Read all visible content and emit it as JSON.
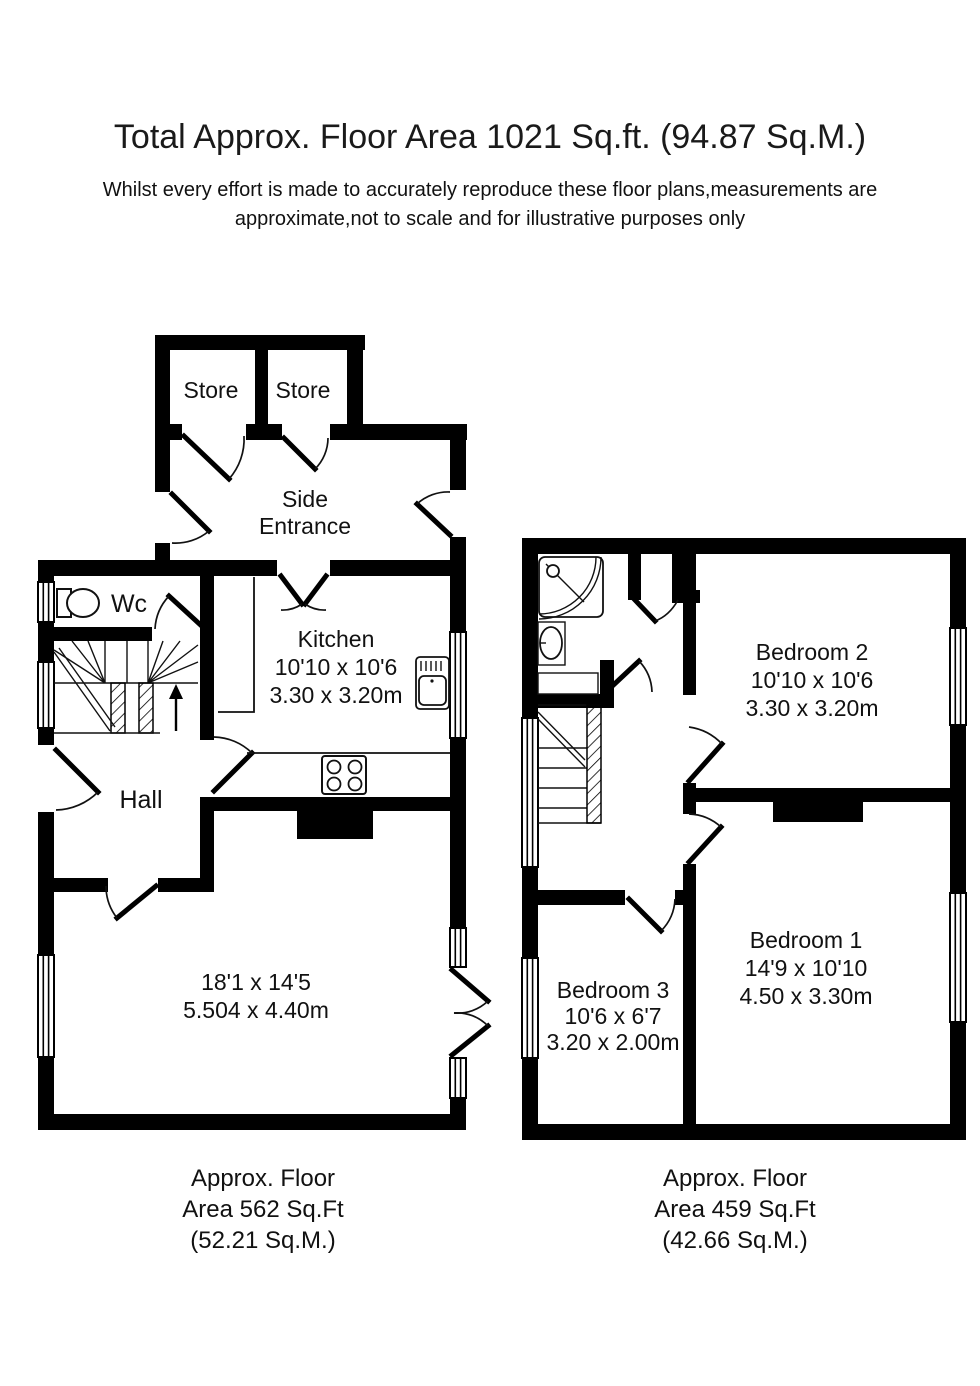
{
  "page": {
    "background": "#ffffff",
    "wall_color": "#000000",
    "text_color": "#1a1a1a"
  },
  "header": {
    "title": "Total Approx. Floor Area 1021 Sq.ft. (94.87 Sq.M.)",
    "disclaimer_line1": "Whilst every effort is made to accurately reproduce these floor plans,measurements are",
    "disclaimer_line2": "approximate,not to scale and for illustrative purposes only"
  },
  "ground_floor": {
    "store_1": "Store",
    "store_2": "Store",
    "side_entrance_line1": "Side",
    "side_entrance_line2": "Entrance",
    "wc": "Wc",
    "kitchen_name": "Kitchen",
    "kitchen_dims_imperial": "10'10 x 10'6",
    "kitchen_dims_metric": "3.30 x 3.20m",
    "hall": "Hall",
    "living_dims_imperial": "18'1 x 14'5",
    "living_dims_metric": "5.504 x 4.40m",
    "area_line1": "Approx. Floor",
    "area_line2": "Area 562 Sq.Ft",
    "area_line3": "(52.21 Sq.M.)"
  },
  "first_floor": {
    "bedroom2_name": "Bedroom 2",
    "bedroom2_dims_imperial": "10'10 x 10'6",
    "bedroom2_dims_metric": "3.30 x 3.20m",
    "bedroom1_name": "Bedroom 1",
    "bedroom1_dims_imperial": "14'9 x 10'10",
    "bedroom1_dims_metric": "4.50 x 3.30m",
    "bedroom3_name": "Bedroom 3",
    "bedroom3_dims_imperial": "10'6 x 6'7",
    "bedroom3_dims_metric": "3.20 x 2.00m",
    "area_line1": "Approx. Floor",
    "area_line2": "Area 459 Sq.Ft",
    "area_line3": "(42.66 Sq.M.)"
  }
}
